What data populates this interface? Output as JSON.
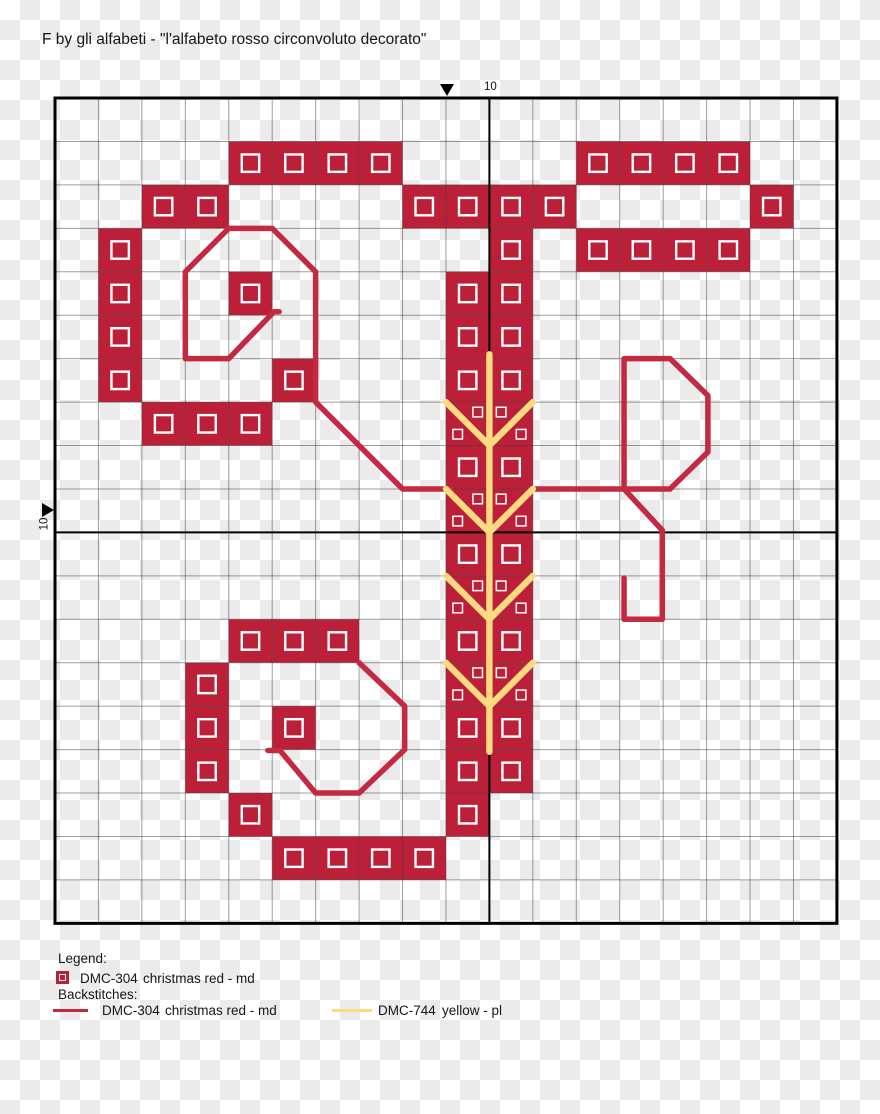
{
  "header": {
    "title": "F by gli alfabeti - \"l'alfabeto rosso circonvoluto decorato\""
  },
  "markers": {
    "top_label": "10",
    "left_label": "10"
  },
  "legend": {
    "heading": "Legend:",
    "stitches": [
      {
        "code": "DMC-304",
        "name": "christmas red - md",
        "symbol": "red-square-with-white-outline"
      }
    ],
    "backstitch_heading": "Backstitches:",
    "backstitches": [
      {
        "code": "DMC-304",
        "name": "christmas red - md",
        "color": "#c32a42"
      },
      {
        "code": "DMC-744",
        "name": "yellow - pl",
        "color": "#fbda82"
      }
    ]
  },
  "chart_data": {
    "type": "cross_stitch_grid",
    "title": "Decorative letter F cross-stitch pattern",
    "design_size": {
      "columns": 18,
      "rows": 19
    },
    "grid": {
      "ox": 55,
      "oy": 98,
      "cell": 43.44,
      "cols": 18,
      "rows": 19,
      "center_col": 10,
      "center_row": 10,
      "symbol_size": 17.4,
      "petite_size": 9.6
    },
    "colors": {
      "red_fill": "#bc2038",
      "red_line": "#c32a42",
      "yellow": "#fbda82",
      "grid_line": "rgba(60,60,60,0.5)",
      "center_line": "#000000",
      "border": "#000000",
      "symbol": "#ffffff"
    },
    "line_widths": {
      "red": 5.5,
      "yellow": 6.4
    },
    "stitches": [
      [
        4,
        1
      ],
      [
        5,
        1
      ],
      [
        6,
        1
      ],
      [
        7,
        1
      ],
      [
        12,
        1
      ],
      [
        13,
        1
      ],
      [
        14,
        1
      ],
      [
        15,
        1
      ],
      [
        2,
        2
      ],
      [
        3,
        2
      ],
      [
        8,
        2
      ],
      [
        9,
        2
      ],
      [
        10,
        2
      ],
      [
        11,
        2
      ],
      [
        16,
        2
      ],
      [
        1,
        3
      ],
      [
        10,
        3
      ],
      [
        12,
        3
      ],
      [
        13,
        3
      ],
      [
        14,
        3
      ],
      [
        15,
        3
      ],
      [
        1,
        4
      ],
      [
        4,
        4
      ],
      [
        9,
        4
      ],
      [
        10,
        4
      ],
      [
        1,
        5
      ],
      [
        9,
        5
      ],
      [
        10,
        5
      ],
      [
        1,
        6
      ],
      [
        5,
        6
      ],
      [
        9,
        6
      ],
      [
        10,
        6
      ],
      [
        2,
        7
      ],
      [
        3,
        7
      ],
      [
        4,
        7
      ],
      [
        9,
        7
      ],
      [
        10,
        7
      ],
      [
        9,
        8
      ],
      [
        10,
        8
      ],
      [
        9,
        9
      ],
      [
        10,
        9
      ],
      [
        9,
        10
      ],
      [
        10,
        10
      ],
      [
        9,
        11
      ],
      [
        10,
        11
      ],
      [
        4,
        12
      ],
      [
        5,
        12
      ],
      [
        6,
        12
      ],
      [
        9,
        12
      ],
      [
        10,
        12
      ],
      [
        3,
        13
      ],
      [
        9,
        13
      ],
      [
        10,
        13
      ],
      [
        3,
        14
      ],
      [
        5,
        14
      ],
      [
        9,
        14
      ],
      [
        10,
        14
      ],
      [
        3,
        15
      ],
      [
        9,
        15
      ],
      [
        10,
        15
      ],
      [
        4,
        16
      ],
      [
        9,
        16
      ],
      [
        5,
        17
      ],
      [
        6,
        17
      ],
      [
        7,
        17
      ],
      [
        8,
        17
      ]
    ],
    "petite_cols": [
      9,
      10
    ],
    "petite_rows": [
      7,
      9,
      11,
      13
    ],
    "petite_layout": [
      [
        [
          0.73,
          0.23
        ],
        [
          0.27,
          0.74
        ]
      ],
      [
        [
          0.27,
          0.23
        ],
        [
          0.73,
          0.74
        ]
      ]
    ],
    "backstitch_red": [
      [
        [
          5.16,
          4.92
        ],
        [
          5.04,
          4.92
        ],
        [
          4,
          6
        ],
        [
          3,
          6
        ],
        [
          3,
          4
        ],
        [
          4,
          3
        ],
        [
          5,
          3
        ],
        [
          6,
          4
        ],
        [
          6,
          7
        ],
        [
          8,
          9
        ],
        [
          9.1,
          9
        ]
      ],
      [
        [
          10.95,
          9
        ],
        [
          14.16,
          9
        ]
      ],
      [
        [
          13.1,
          9
        ],
        [
          13.1,
          6
        ],
        [
          14.16,
          6
        ],
        [
          15.03,
          6.85
        ],
        [
          15.03,
          8.15
        ],
        [
          14.16,
          9
        ]
      ],
      [
        [
          13.1,
          9
        ],
        [
          13.98,
          9.95
        ],
        [
          13.98,
          12
        ],
        [
          13.1,
          12
        ],
        [
          13.1,
          11.05
        ]
      ],
      [
        [
          4.9,
          15.02
        ],
        [
          5.18,
          15.02
        ],
        [
          6,
          16
        ],
        [
          7,
          16
        ],
        [
          8.05,
          15
        ],
        [
          8.05,
          14
        ],
        [
          7,
          13
        ]
      ]
    ],
    "backstitch_yellow": [
      [
        [
          10,
          5.9
        ],
        [
          10,
          15.05
        ]
      ],
      [
        [
          9,
          7
        ],
        [
          10,
          8
        ]
      ],
      [
        [
          11,
          7
        ],
        [
          10,
          8
        ]
      ],
      [
        [
          9,
          9
        ],
        [
          10,
          10
        ]
      ],
      [
        [
          11,
          9
        ],
        [
          10,
          10
        ]
      ],
      [
        [
          9,
          11
        ],
        [
          10,
          12
        ]
      ],
      [
        [
          11,
          11
        ],
        [
          10,
          12
        ]
      ],
      [
        [
          9,
          13
        ],
        [
          10,
          14
        ]
      ],
      [
        [
          11,
          13
        ],
        [
          10,
          14
        ]
      ]
    ]
  }
}
